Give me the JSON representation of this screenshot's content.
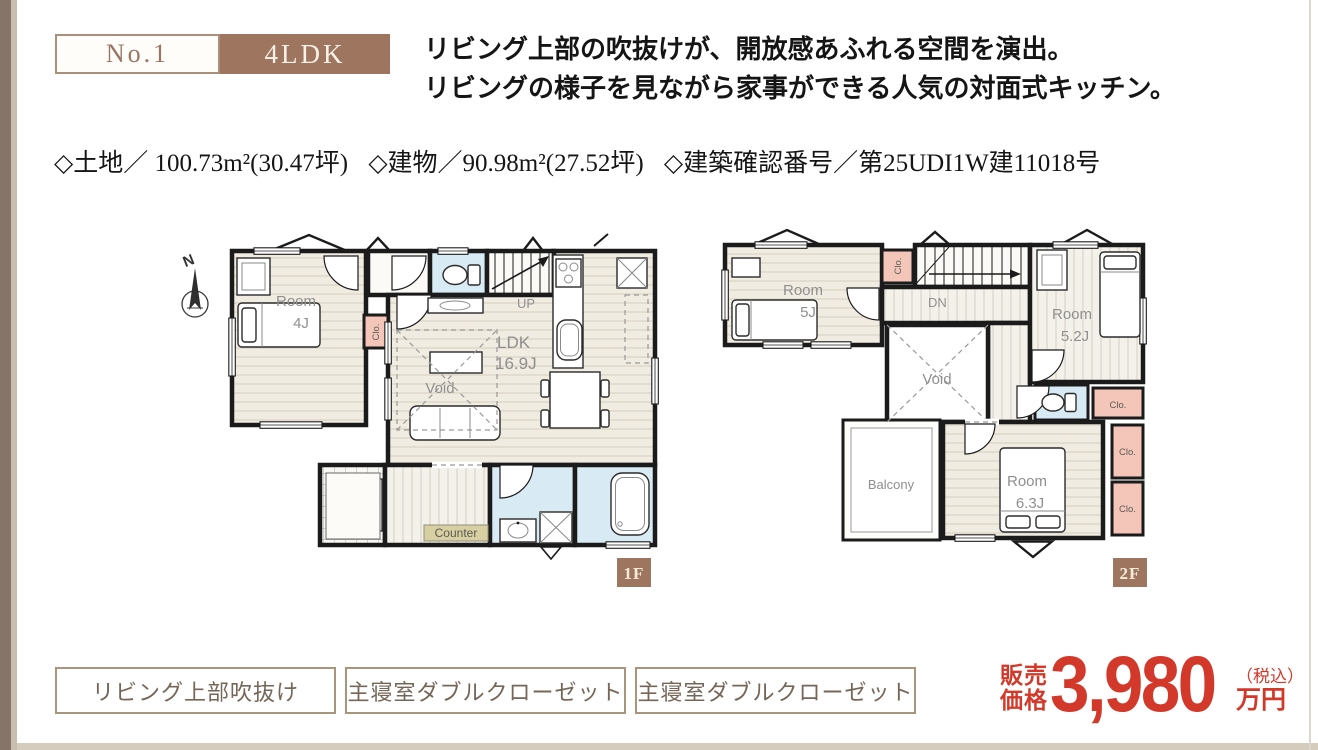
{
  "header": {
    "number_label": "No.1",
    "type_label": "4LDK",
    "headline_line1": "リビング上部の吹抜けが、開放感あふれる空間を演出。",
    "headline_line2": "リビングの様子を見ながら家事ができる人気の対面式キッチン。"
  },
  "property_info": {
    "land": "◇土地／ 100.73m²(30.47坪)",
    "building": "◇建物／90.98m²(27.52坪)",
    "confirmation": "◇建築確認番号／第25UDI1W建11018号"
  },
  "floorplan_1f": {
    "floor_label": "1F",
    "compass_n": "N",
    "room_name": "Room",
    "room_size": "4J",
    "closet": "Clo.",
    "stairs_up": "UP",
    "ldk_name": "LDK",
    "ldk_size": "16.9J",
    "void_label": "Void",
    "counter_label": "Counter"
  },
  "floorplan_2f": {
    "floor_label": "2F",
    "room1_name": "Room",
    "room1_size": "5J",
    "room2_name": "Room",
    "room2_size": "5.2J",
    "room3_name": "Room",
    "room3_size": "6.3J",
    "closet1": "Clo.",
    "closet2": "Clo.",
    "closet3": "Clo.",
    "closet4": "Clo.",
    "stairs_dn": "DN",
    "void_label": "Void",
    "balcony_label": "Balcony"
  },
  "features": {
    "item1": "リビング上部吹抜け",
    "item2": "主寝室ダブルクローゼット",
    "item3": "主寝室ダブルクローゼット"
  },
  "price": {
    "label_top": "販売",
    "label_bottom": "価格",
    "amount": "3,980",
    "tax_note": "（税込）",
    "unit": "万円"
  },
  "colors": {
    "brand_brown": "#9e7660",
    "accent_red": "#d2392a",
    "closet_pink": "#f3c6b9",
    "wet_area_blue": "#d8eaf3"
  }
}
